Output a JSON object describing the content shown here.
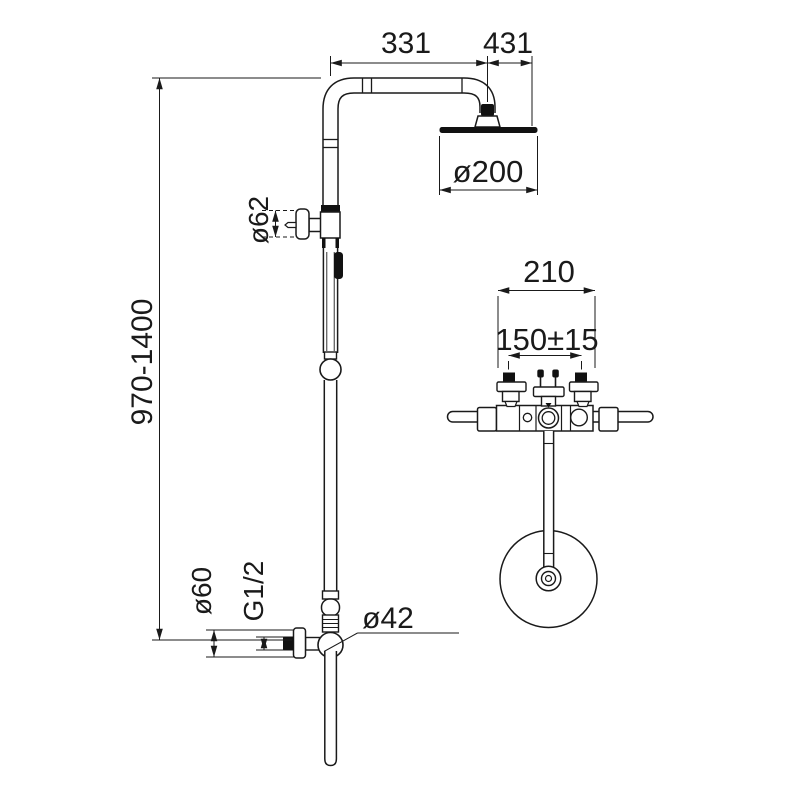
{
  "meta": {
    "type": "technical-dimension-drawing",
    "subject": "shower column with overhead rain shower, diverter and hand shower",
    "views": [
      "side-view-column",
      "top-view-mixer"
    ]
  },
  "colors": {
    "line": "#1a1a1a",
    "background": "#ffffff",
    "solid_fill": "#111111"
  },
  "labels": {
    "arm_length": "331",
    "total_reach": "431",
    "head_diameter": "ø200",
    "diverter_knob_diameter": "ø62",
    "height_range": "970-1400",
    "bar_width": "210",
    "inlet_spacing": "150±15",
    "escutcheon_diameter": "ø60",
    "thread_size": "G1/2",
    "pipe_diameter": "ø42"
  }
}
